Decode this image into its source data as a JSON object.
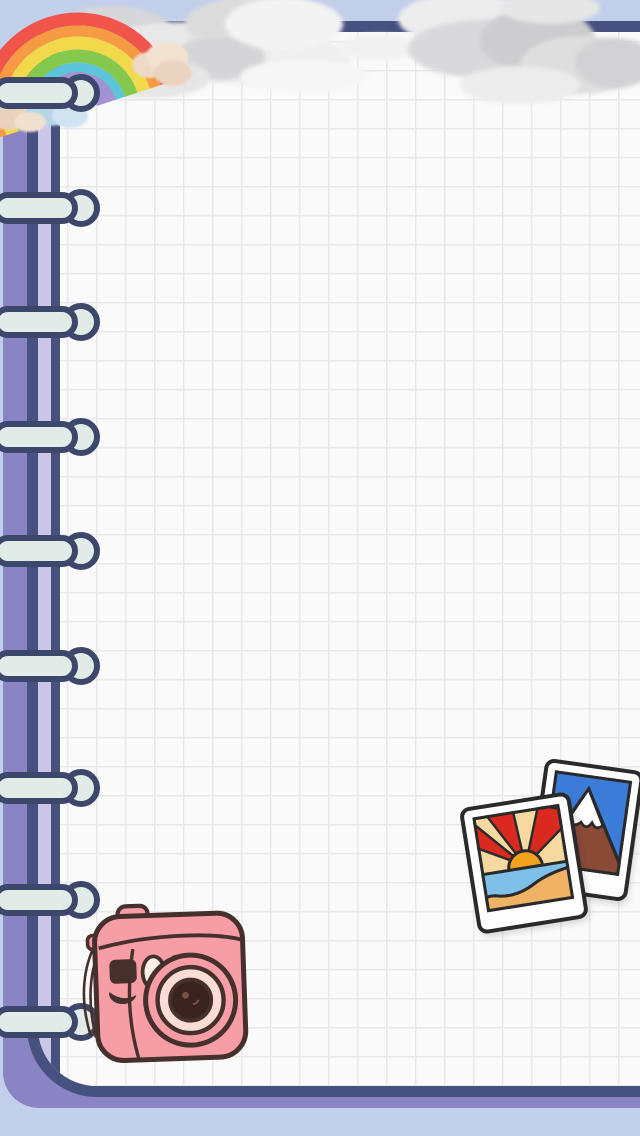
{
  "scene": {
    "description": "Cute stationery wallpaper: spiral grid-paper notebook page with rainbow, clouds and photo stickers",
    "background_color": "#c2cfeb",
    "notebook": {
      "cover_color": "#8a84c4",
      "outline_color": "#47517f",
      "page_color": "#fbfafa",
      "grid_color": "#e8e8ec",
      "margin_stripe_color": "#c9c6e8",
      "ring_count": 9,
      "ring_fill": "#e1ebe8",
      "ring_outline": "#3c476b",
      "ring_centers_y": [
        93,
        208,
        322,
        437,
        551,
        666,
        788,
        900,
        1022
      ]
    },
    "clouds": {
      "base_color": "#dcdcde",
      "highlight_color": "#f3f3f4"
    },
    "stickers": {
      "rainbow": {
        "band_colors": [
          "#f1544b",
          "#f69a43",
          "#f2d84b",
          "#85c84e",
          "#5ec4d9",
          "#a292d2"
        ],
        "end_cloud_colors": [
          "#efdccb",
          "#b7d6e8"
        ]
      },
      "camera": {
        "body_color": "#f79da6",
        "outline_color": "#46302c",
        "lens_ring_color": "#fbdcd7",
        "lens_center_color": "#38231f",
        "flash_color": "#fdf1ea"
      },
      "polaroid_sunset": {
        "frame_color": "#fdfdfd",
        "outline_color": "#2a2a2a",
        "sky_color": "#f5d9a0",
        "ray_color": "#da2a20",
        "sun_color": "#f2a21d",
        "water_color": "#7fc0e8",
        "sand_color": "#f0b264"
      },
      "polaroid_mountain": {
        "frame_color": "#fdfdfd",
        "outline_color": "#2a2a2a",
        "sky_color": "#3a7cd8",
        "mountain_color": "#8a4a36",
        "snow_color": "#ffffff"
      }
    }
  }
}
